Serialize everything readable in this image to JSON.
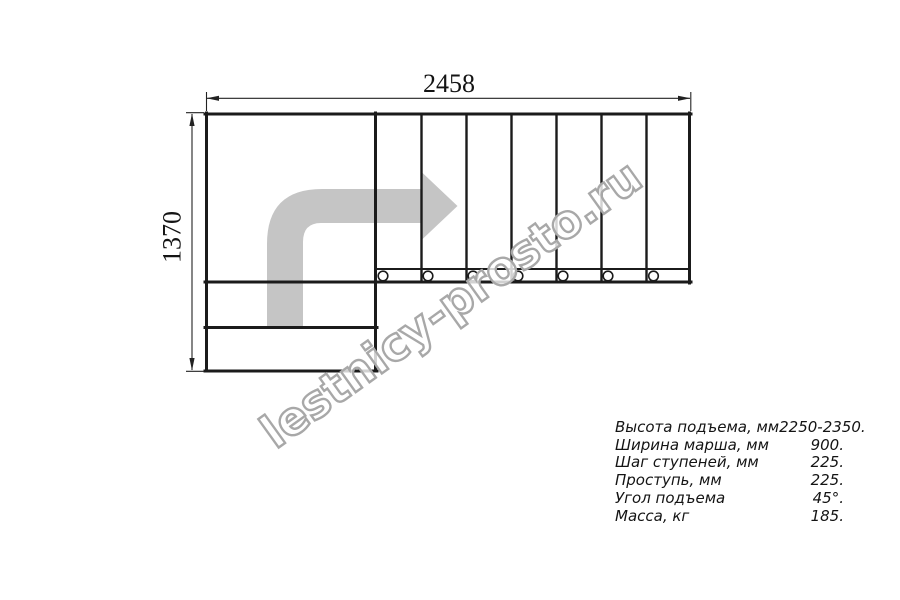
{
  "drawing": {
    "width_dimension": "2458",
    "height_dimension": "1370",
    "watermark": "lestnicy-prosto.ru"
  },
  "specs": {
    "rows": [
      {
        "label": "Высота подъема, мм",
        "value": "2250-2350."
      },
      {
        "label": "Ширина марша, мм",
        "value": "900."
      },
      {
        "label": "Шаг ступеней, мм",
        "value": "225."
      },
      {
        "label": "Проступь, мм",
        "value": "225."
      },
      {
        "label": "Угол подъема",
        "value": "45°."
      },
      {
        "label": "Масса, кг",
        "value": "185."
      }
    ]
  },
  "colors": {
    "line": "#1b1b1b",
    "dim": "#222222",
    "arrow_fill": "#c5c5c5",
    "watermark_stroke": "#a8a8a8",
    "text": "#141414",
    "background": "#ffffff"
  }
}
